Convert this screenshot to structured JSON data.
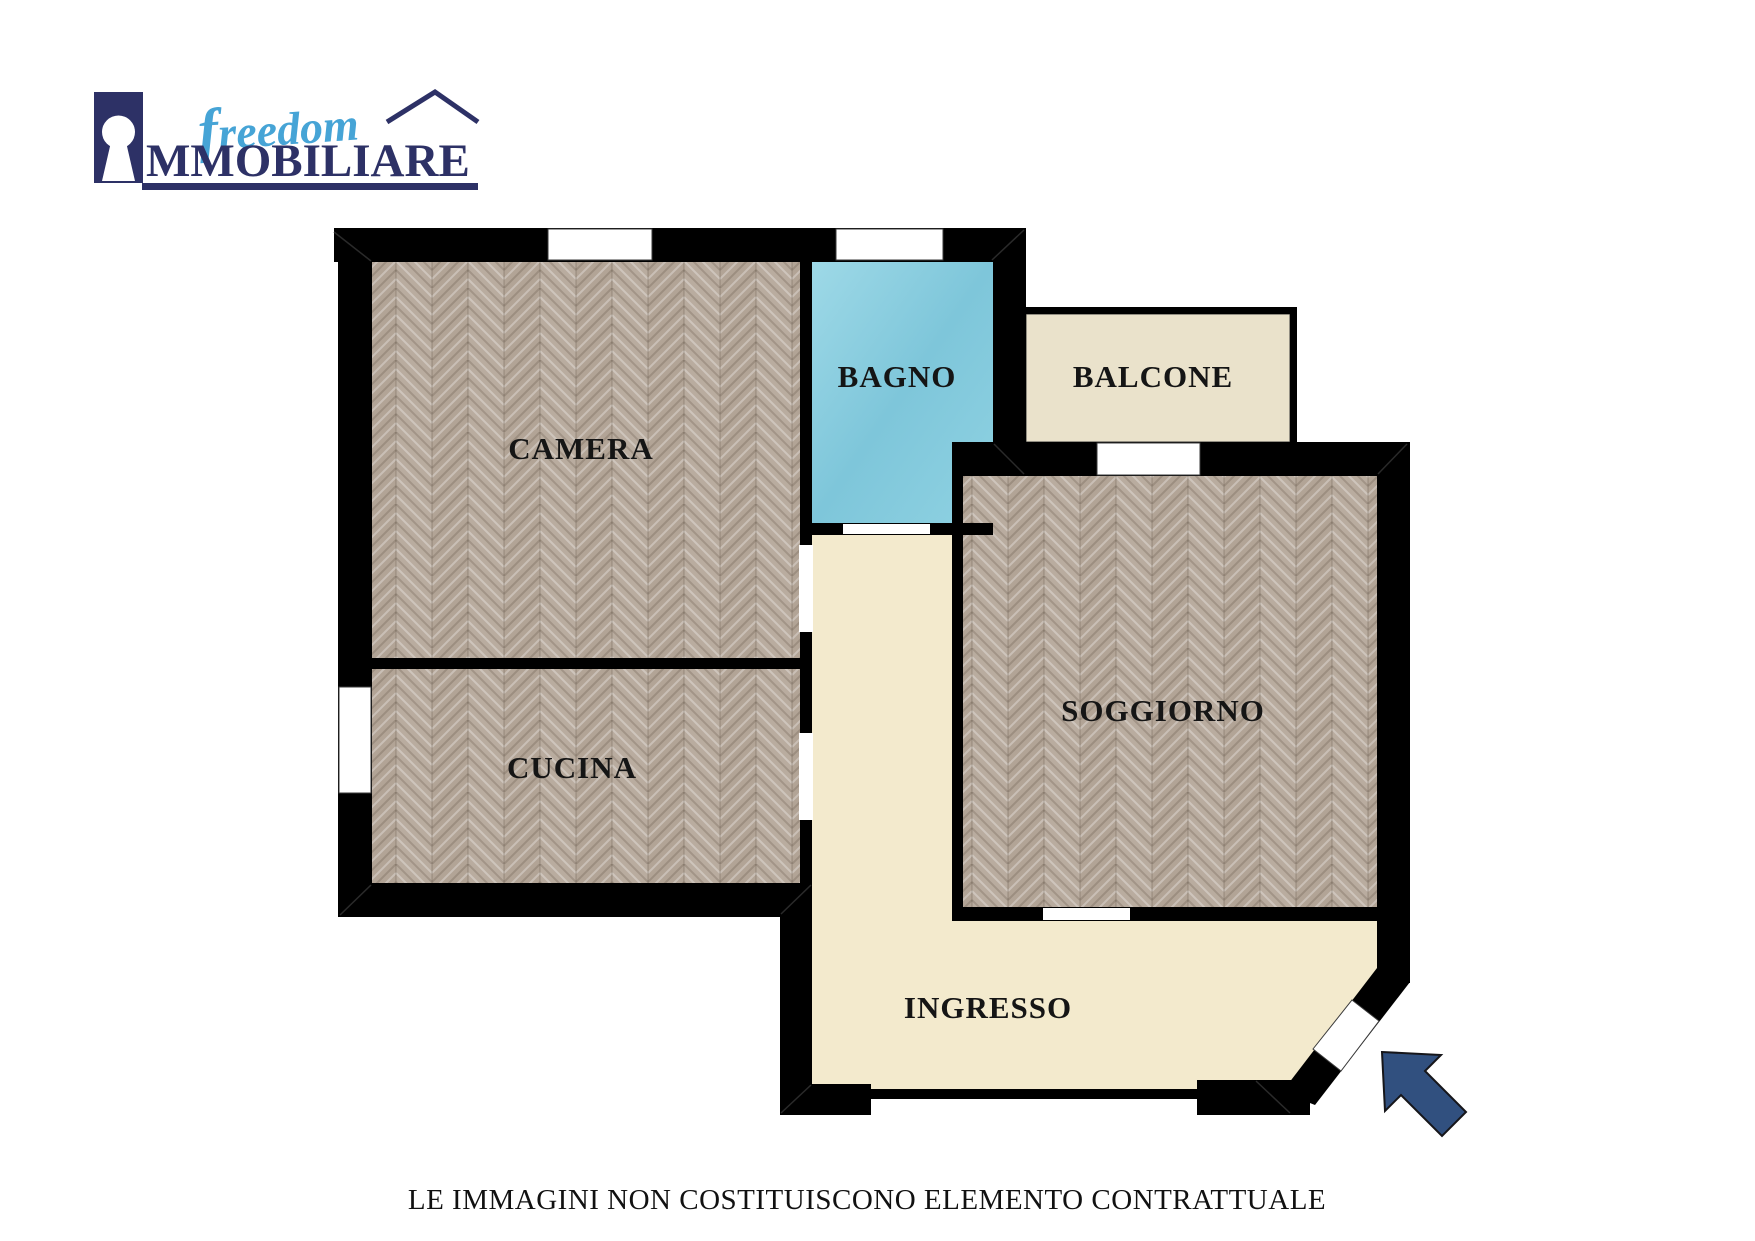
{
  "page": {
    "footer_disclaimer": "LE IMMAGINI NON COSTITUISCONO ELEMENTO CONTRATTUALE"
  },
  "logo": {
    "script_word": "freedom",
    "caps_word": "MMOBILIARE",
    "icons": [
      "keyhole-icon",
      "house-roof-icon"
    ]
  },
  "floorplan": {
    "rooms": [
      {
        "id": "camera",
        "label": "CAMERA",
        "floor": "wood-herringbone"
      },
      {
        "id": "cucina",
        "label": "CUCINA",
        "floor": "wood-herringbone"
      },
      {
        "id": "bagno",
        "label": "BAGNO",
        "floor": "azure-tile"
      },
      {
        "id": "balcone",
        "label": "BALCONE",
        "floor": "cream-plaster"
      },
      {
        "id": "soggiorno",
        "label": "SOGGIORNO",
        "floor": "wood-herringbone"
      },
      {
        "id": "ingresso",
        "label": "INGRESSO",
        "floor": "cream-plaster"
      }
    ],
    "entrance_arrow_direction": "up-left"
  },
  "colors": {
    "page": "#ffffff",
    "wall": "#000000",
    "navy": "#2d3166",
    "script_blue": "#46a4d6",
    "arrow": "#31507f",
    "wood": "#b5a99c",
    "bath_tile": "#8ed1e1",
    "balcony_floor": "#eae2cb",
    "hall_floor": "#f3eacd"
  }
}
